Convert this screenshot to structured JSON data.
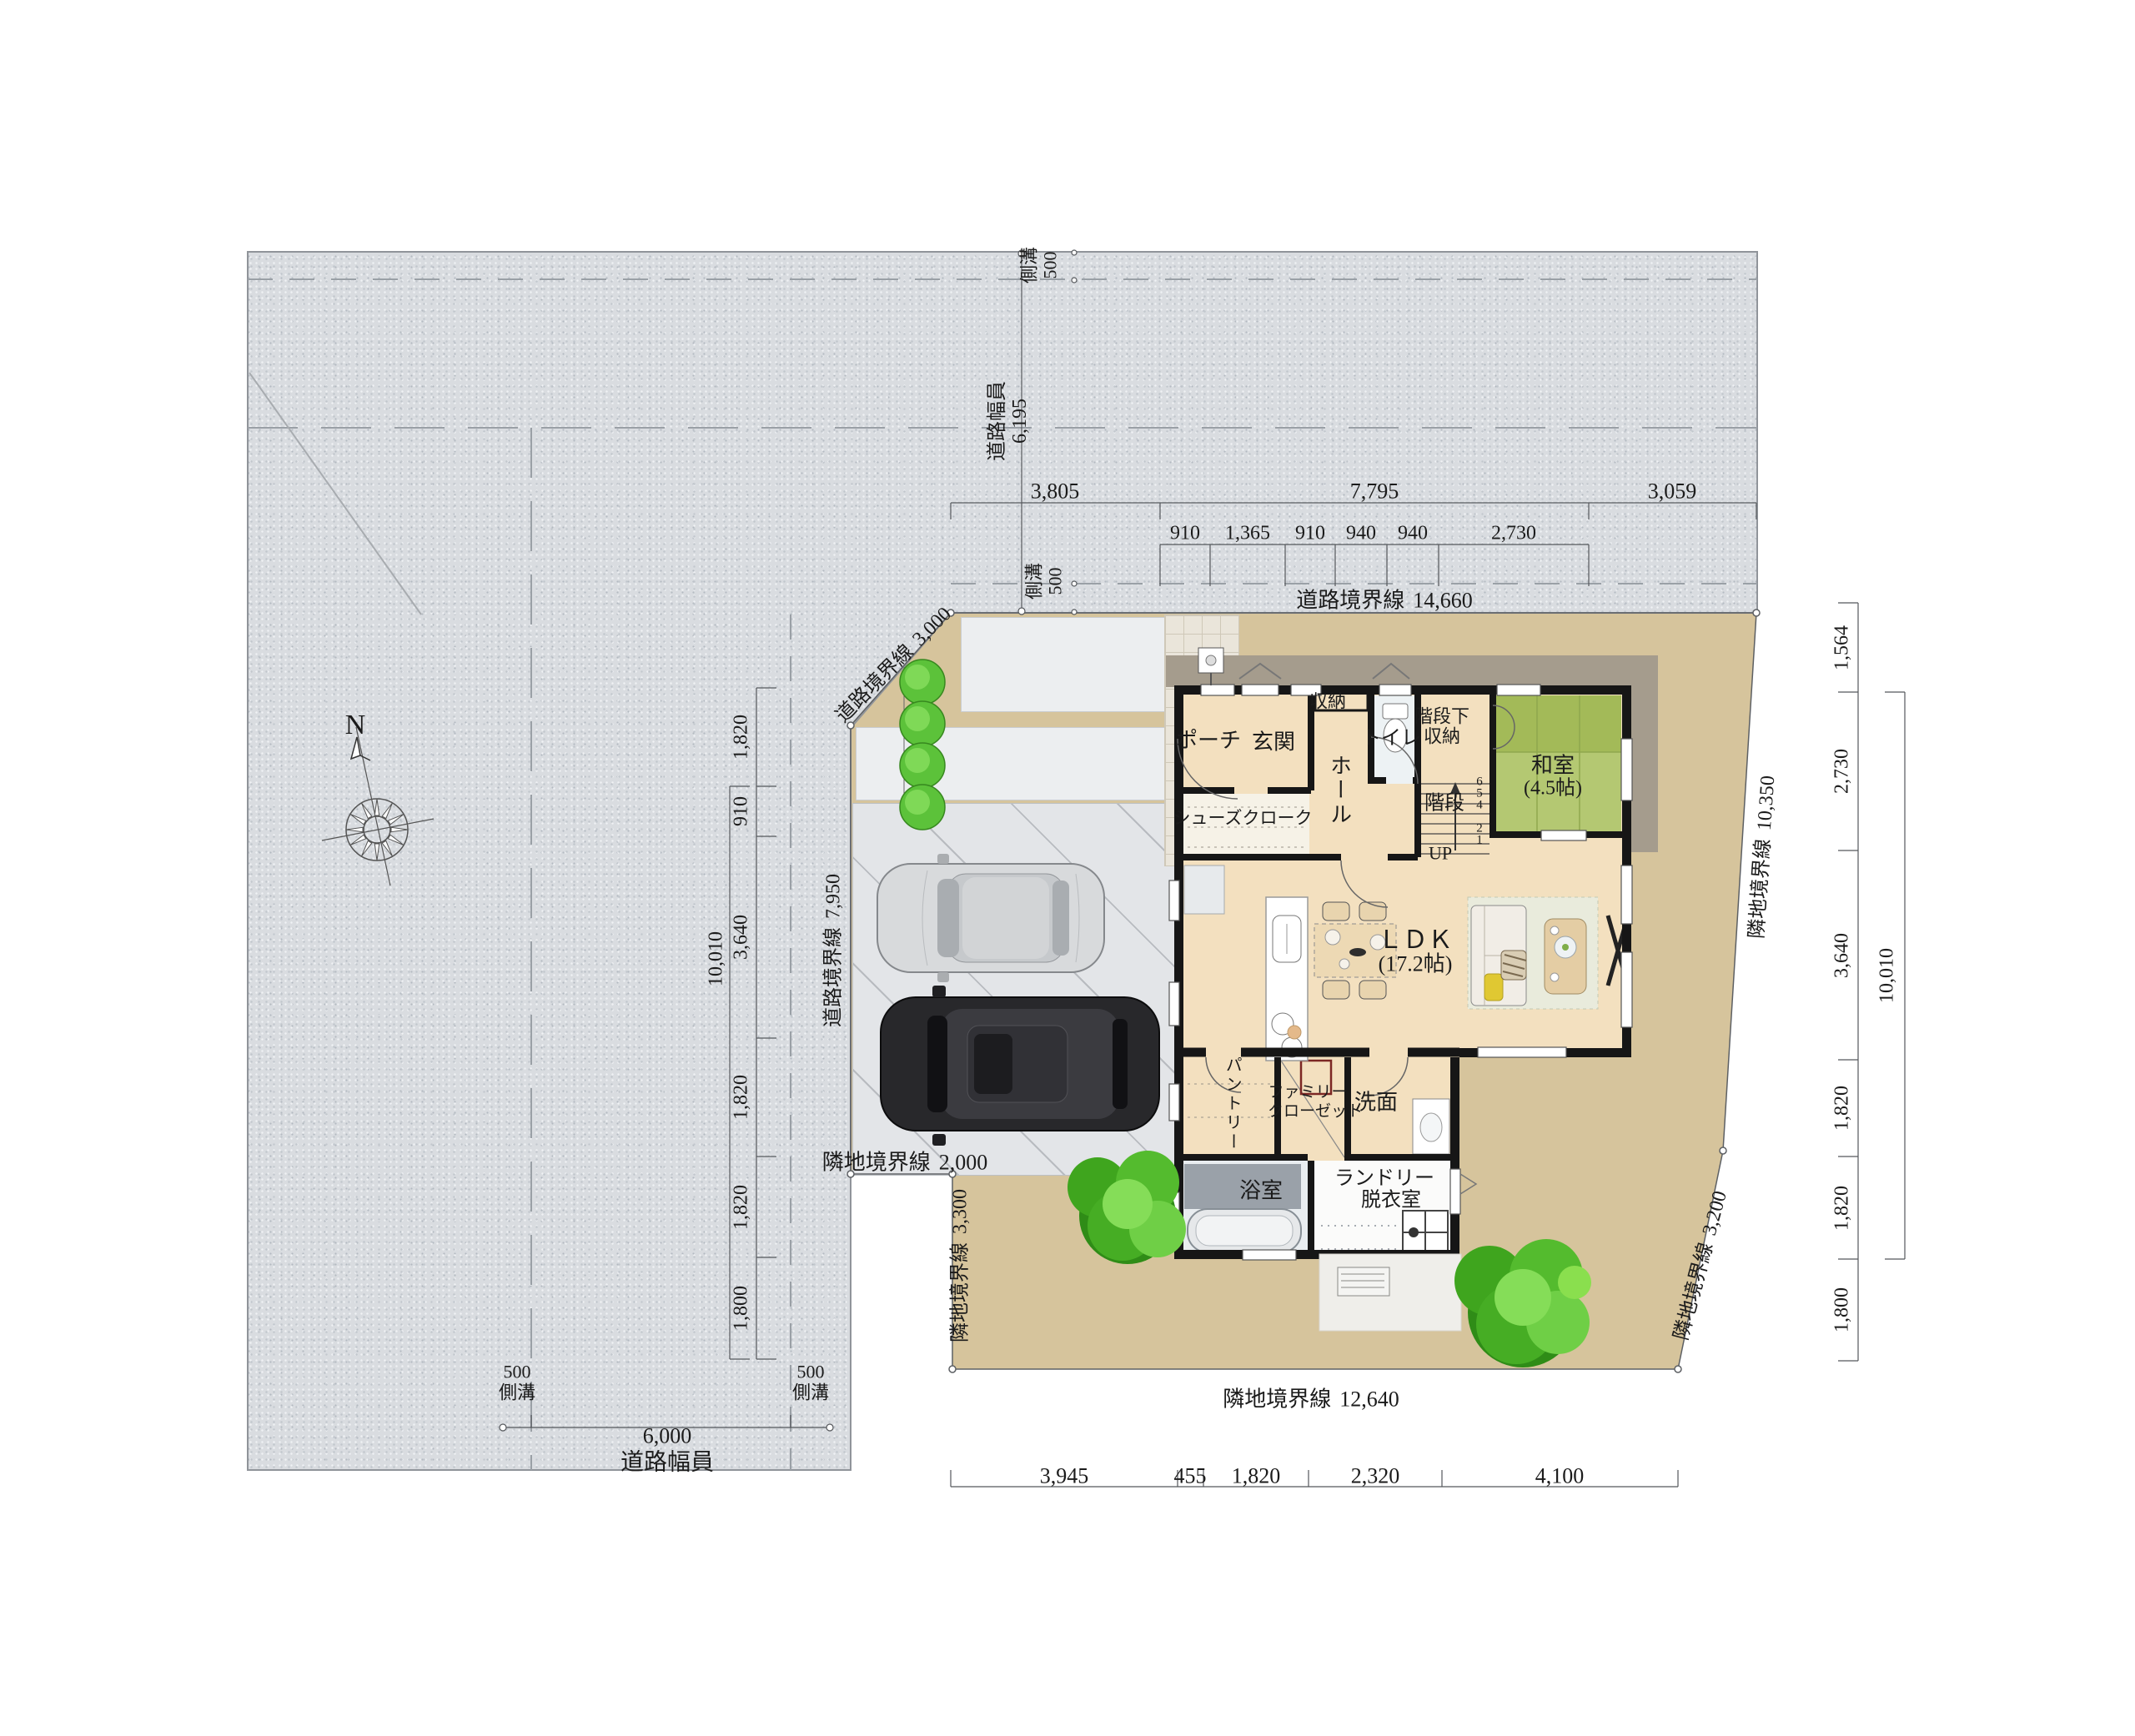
{
  "colors": {
    "road": "#d9dce0",
    "lot": "#d6c49c",
    "wood_floor": "#f3e0bf",
    "tatami": "#b4c872",
    "wall": "#161616",
    "parking": "#e3e5e8",
    "tree_green": "#4db52e",
    "accent_pillow": "#e0c832"
  },
  "compass": {
    "north": "N"
  },
  "road_labels": {
    "top_gutter_upper": {
      "name": "側溝",
      "value": "500"
    },
    "top_gutter_lower": {
      "name": "側溝",
      "value": "500"
    },
    "top_width": {
      "name": "道路幅員",
      "value": "6,195"
    },
    "left_width": {
      "name": "道路幅員",
      "value": "6,000"
    },
    "left_gutter_west": {
      "name": "側溝",
      "value": "500"
    },
    "left_gutter_east": {
      "name": "側溝",
      "value": "500"
    }
  },
  "boundaries": {
    "road_north": {
      "label": "道路境界線",
      "value": "14,660"
    },
    "road_corner": {
      "label": "道路境界線",
      "value": "3,000"
    },
    "road_west": {
      "label": "道路境界線",
      "value": "7,950"
    },
    "neighbor_sw": {
      "label": "隣地境界線",
      "value": "2,000"
    },
    "neighbor_west_lower": {
      "label": "隣地境界線",
      "value": "3,300"
    },
    "neighbor_south": {
      "label": "隣地境界線",
      "value": "12,640"
    },
    "neighbor_se": {
      "label": "隣地境界線",
      "value": "3,200"
    },
    "neighbor_east": {
      "label": "隣地境界線",
      "value": "10,350"
    }
  },
  "dimensions": {
    "top_overall": [
      "3,805",
      "7,795",
      "3,059"
    ],
    "top_grid": [
      "910",
      "1,365",
      "910",
      "940",
      "940",
      "2,730"
    ],
    "right_side": [
      "1,564",
      "2,730",
      "3,640",
      "1,820",
      "1,820",
      "1,800"
    ],
    "right_total": "10,010",
    "left_side": [
      "1,820",
      "910",
      "3,640",
      "1,820",
      "1,820",
      "1,800"
    ],
    "left_total": "10,010",
    "bottom": [
      "3,945",
      "455",
      "1,820",
      "2,320",
      "4,100"
    ]
  },
  "rooms": {
    "porch": "ポーチ",
    "entrance": "玄関",
    "storage": "収納",
    "toilet": "トイレ",
    "under_stair_1": "階段下",
    "under_stair_2": "収納",
    "washitsu": "和室",
    "washitsu_size": "(4.5帖)",
    "hall": "ホール",
    "shoe_closet": "シューズクローク",
    "stairs": "階段",
    "up": "UP",
    "stair_steps": [
      "6",
      "5",
      "4",
      "2",
      "1"
    ],
    "ldk": "ＬＤＫ",
    "ldk_size": "(17.2帖)",
    "pantry": "パントリー",
    "family_closet_1": "ファミリー",
    "family_closet_2": "クローゼット",
    "washroom": "洗面",
    "bathroom": "浴室",
    "laundry_1": "ランドリー",
    "laundry_2": "脱衣室"
  }
}
